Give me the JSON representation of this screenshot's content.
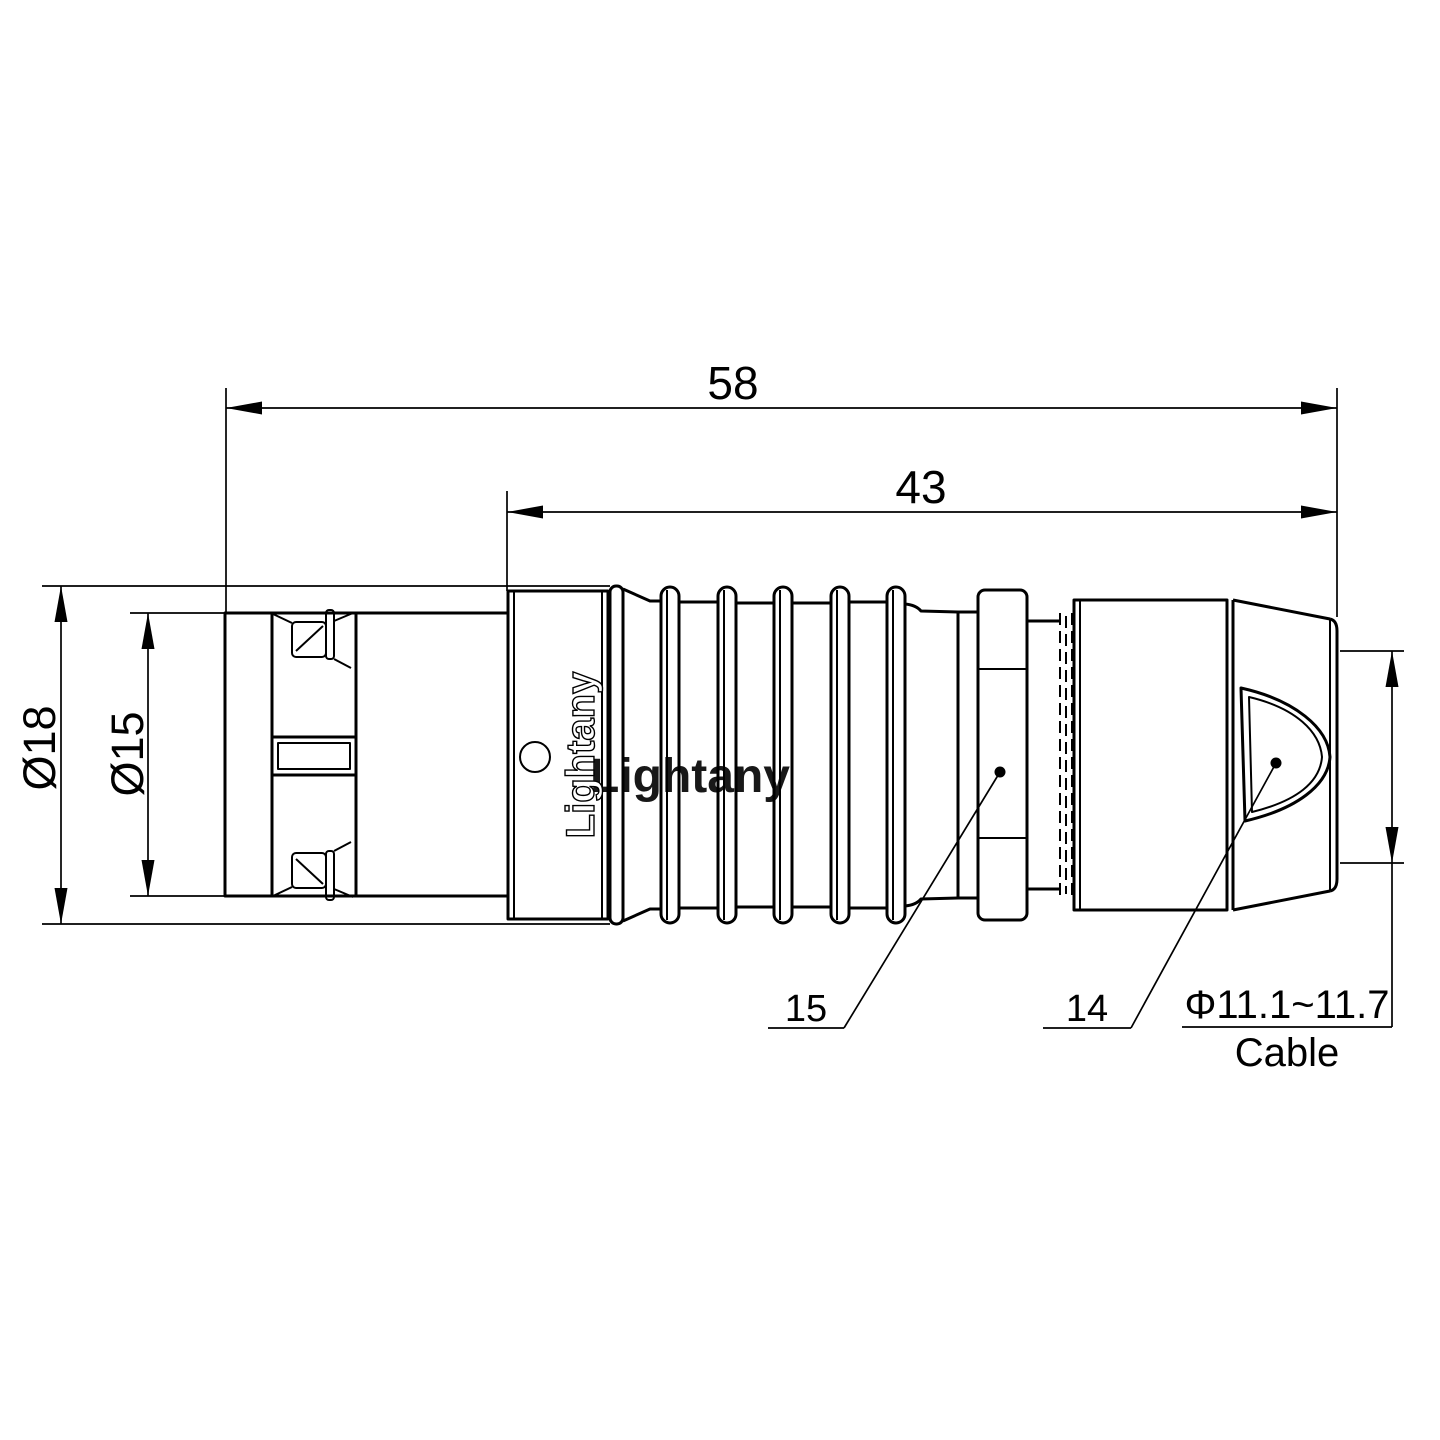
{
  "title": "Push-pull circular connector technical drawing, side view",
  "brand": {
    "logo_text": "Lightany",
    "watermark_text": "Lightany"
  },
  "dimensions": {
    "overall_length": "58",
    "rear_length": "43",
    "outer_diameter": "Ø18",
    "front_diameter": "Ø15",
    "cable_diameter": "Φ11.1~11.7",
    "cable_label": "Cable"
  },
  "part_refs": {
    "collar_ref": "15",
    "back_nut_ref": "14"
  },
  "colors": {
    "line": "#000000",
    "watermark_pink": "#f5cdc7",
    "background": "#ffffff"
  }
}
